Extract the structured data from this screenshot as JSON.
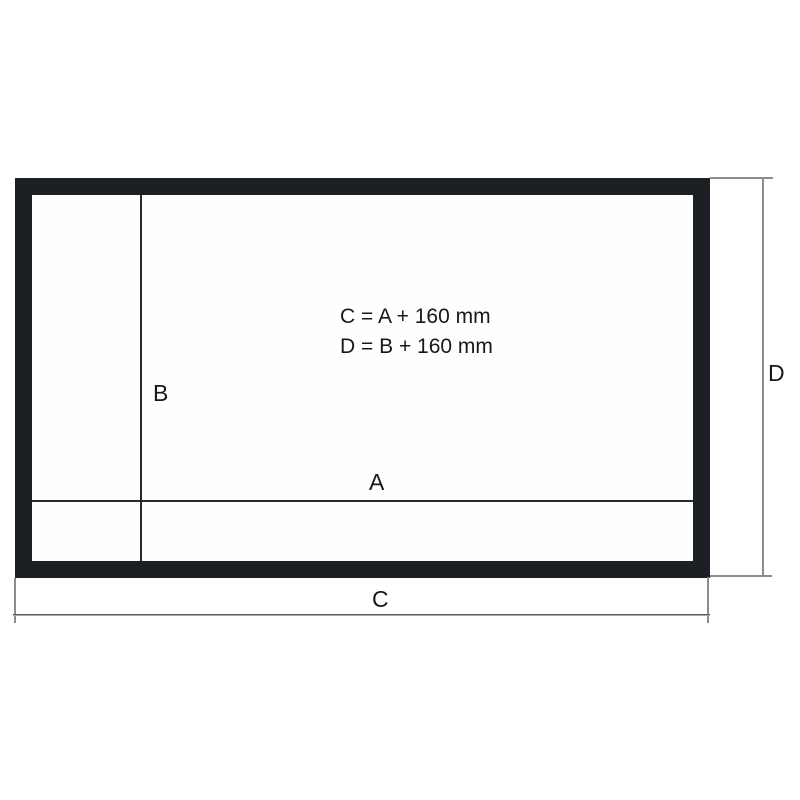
{
  "diagram": {
    "formulas": [
      "C = A + 160 mm",
      "D = B + 160 mm"
    ],
    "labels": {
      "a": "A",
      "b": "B",
      "c": "C",
      "d": "D"
    },
    "colors": {
      "frame": "#1c1f24",
      "inner_line": "#26282d",
      "dimension_line": "#8c8c8c",
      "text": "#17181a",
      "background": "#ffffff"
    }
  }
}
